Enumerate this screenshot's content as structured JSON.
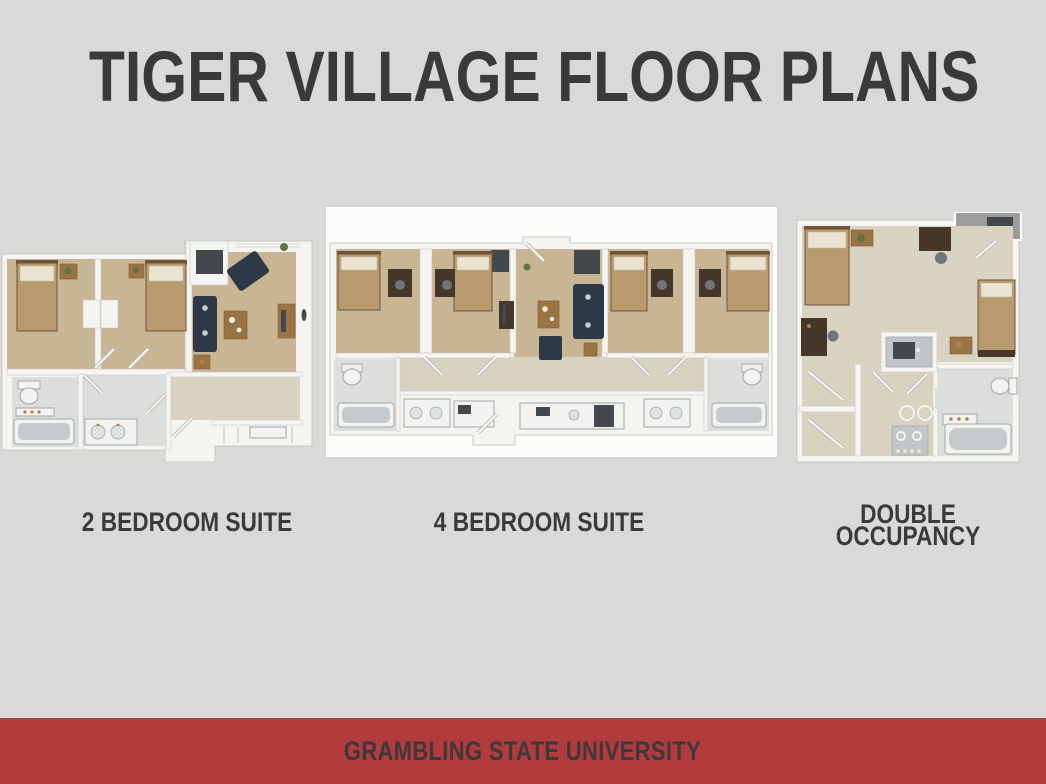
{
  "slide": {
    "title": "TIGER VILLAGE FLOOR PLANS"
  },
  "floor_plans": [
    {
      "id": "2-bedroom-suite",
      "label": "2 BEDROOM SUITE"
    },
    {
      "id": "4-bedroom-suite",
      "label": "4 BEDROOM SUITE"
    },
    {
      "id": "double-occupancy",
      "label": "DOUBLE OCCUPANCY"
    }
  ],
  "footer": {
    "text": "GRAMBLING STATE UNIVERSITY"
  },
  "colors": {
    "bg": "#d9dad7",
    "ink": "#3a393b",
    "red": "#b23b3d",
    "footer_ink": "#3d393a",
    "card": "#fcfcfb",
    "wall": "#f5f4f1",
    "wall_line": "#c7c7c4",
    "carpet": "#c8b593",
    "hall": "#d8d2c0",
    "bath": "#dcdedb",
    "bed": "#b79b6e",
    "bed_dark": "#6f5538",
    "pillow": "#eae3d1",
    "navy": "#2d3947",
    "wood": "#9b7444",
    "wood_dark": "#46372b",
    "dark_item": "#43484d",
    "fixture": "#f2f2f0",
    "fixture_line": "#9fa5a7",
    "tub": "#c5cacc",
    "sink": "#dde1e1",
    "appliance": "#c3c6c8",
    "balcony": "#9c9c9a",
    "plant": "#5f7246",
    "gold": "#a8854a",
    "chair": "#70757a",
    "door": "#f6f6f3",
    "door_edge": "#b7b7b4"
  }
}
